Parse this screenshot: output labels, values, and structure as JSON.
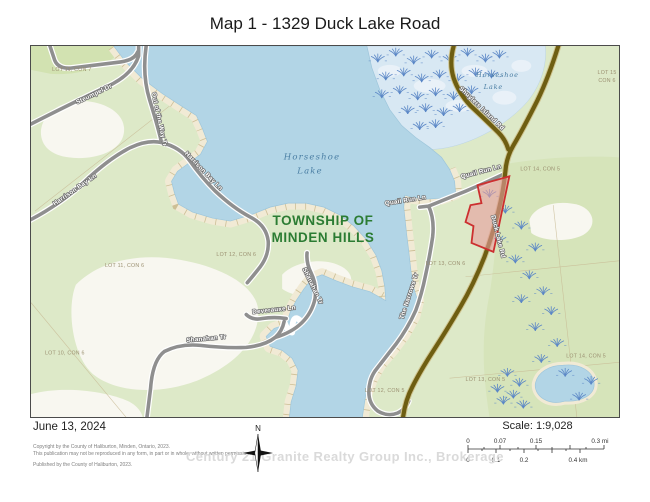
{
  "title": "Map 1 - 1329 Duck Lake Road",
  "map": {
    "township_line1": "TOWNSHIP OF",
    "township_line2": "MINDEN HILLS",
    "lake_line1": "Horseshoe",
    "lake_line2": "Lake",
    "marsh_lake_line1": "Horseshoe",
    "marsh_lake_line2": "Lake",
    "road_labels": [
      "Steumpel Dr",
      "Harrison Bay Ln",
      "Harrison Bay Ln",
      "Out of the Way Tr",
      "Shanahan Tr",
      "Shanahan Tr",
      "Deverauxe Ln",
      "The Narrows Tr",
      "Quail Run Ln",
      "Quail Run Ln",
      "Duck Lake Rd",
      "Shuylers Island Rd"
    ],
    "lot_labels": [
      "LOT 11, CON 7",
      "LOT 11, CON 6",
      "LOT 10, CON 6",
      "LOT 12, CON 6",
      "LOT 12, CON 5",
      "LOT 13, CON 6",
      "LOT 13, CON 5",
      "LOT 14, CON 5",
      "LOT 14, CON 5",
      "LOT 15",
      "CON 6"
    ],
    "colors": {
      "water": "#b2d5e6",
      "marsh": "#d8e8f3",
      "land": "#dde9c8",
      "highlight_parcel": "#cc2f2f"
    }
  },
  "footer": {
    "date": "June 13, 2024",
    "copyright_line1": "Copyright by the County of Haliburton, Minden, Ontario, 2023.",
    "copyright_line2": "This publication may not be reproduced in any form, in part or in whole, without written permission.",
    "copyright_line3": "Published by the County of Haliburton, 2023.",
    "north_label": "N",
    "scale_label": "Scale: 1:9,028",
    "scalebar_mi": [
      "0",
      "0.07",
      "0.15",
      "0.3 mi"
    ],
    "scalebar_km": [
      "0",
      "0.1",
      "0.2",
      "0.4 km"
    ],
    "watermark": "Century 21 Granite Realty Group Inc., Brokerage"
  }
}
